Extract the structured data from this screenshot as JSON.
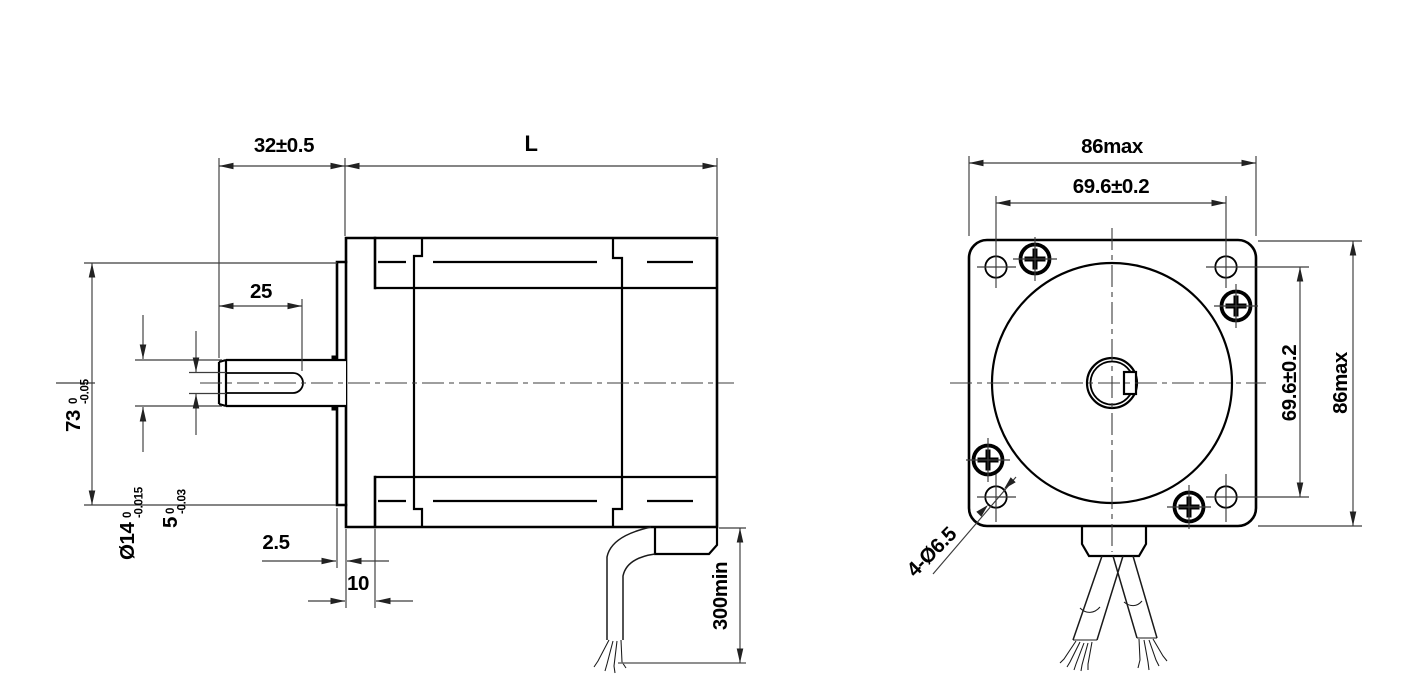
{
  "colors": {
    "line": "#000000",
    "dim_line": "#3c3c3c",
    "background": "#ffffff"
  },
  "side_view": {
    "dim_shaft_extension": "32±0.5",
    "dim_motor_length": "L",
    "dim_flat_length": "25",
    "dim_pilot_diameter": {
      "value": "73",
      "tol_upper": "0",
      "tol_lower": "-0.05"
    },
    "dim_shaft_diameter": {
      "value": "Ø14",
      "tol_upper": "0",
      "tol_lower": "-0.015"
    },
    "dim_shaft_flat": {
      "value": "5",
      "tol_upper": "0",
      "tol_lower": "-0.03"
    },
    "dim_pilot_depth": "2.5",
    "dim_front_cap_width": "10",
    "dim_lead_wire_length": "300min"
  },
  "front_view": {
    "dim_body_width": "86max",
    "dim_hole_spacing_horizontal": "69.6±0.2",
    "dim_hole_spacing_vertical": "69.6±0.2",
    "dim_body_height": "86max",
    "label_mounting_holes": "4-Ø6.5"
  }
}
